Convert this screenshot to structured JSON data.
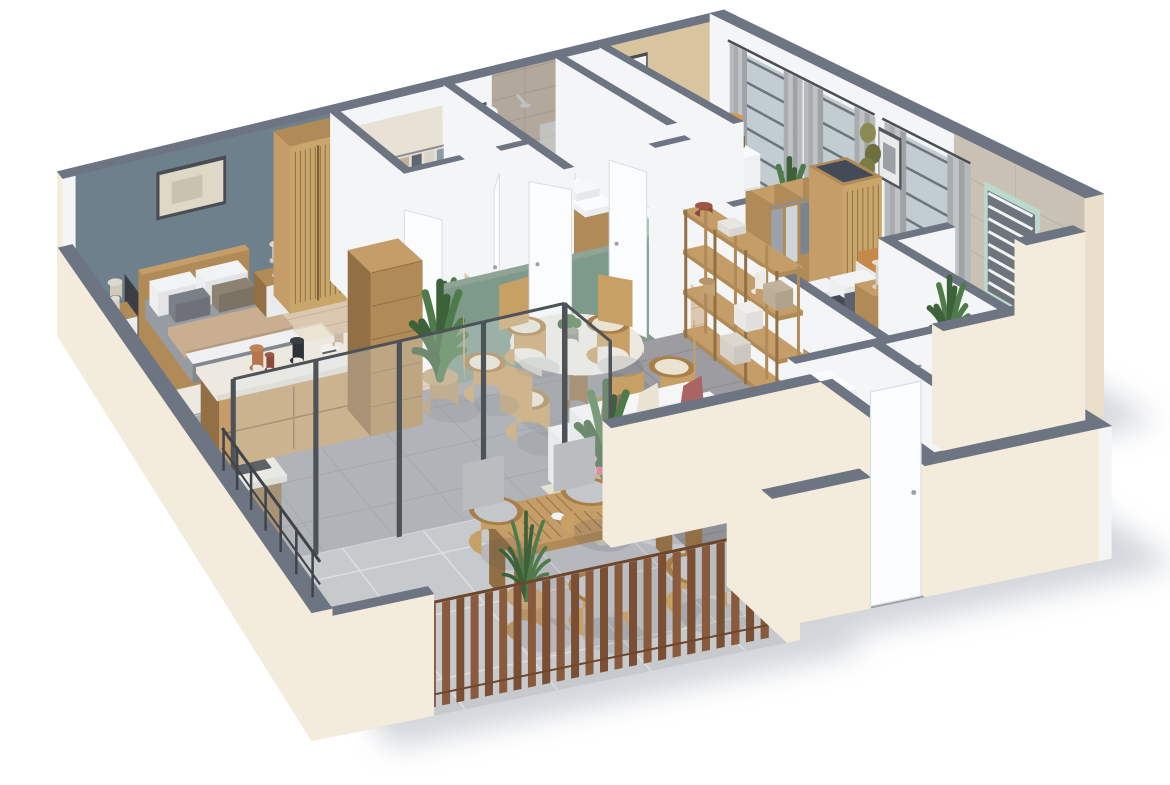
{
  "meta": {
    "title": "3D isometric apartment floor plan render",
    "style": "photoreal cutaway dollhouse view, white background, soft drop shadow"
  },
  "palette": {
    "background": "#ffffff",
    "shadow": "#c6cad0",
    "wallTop": "#6d7583",
    "wallTopDark": "#5d6572",
    "extWall": "#f3ebdb",
    "extWallDark": "#e9dfca",
    "intWall": "#f3f5f7",
    "intWallShade": "#e4e8ed",
    "intWallDark": "#d7dce2",
    "blueWall": "#6d808c",
    "tanWall": "#d8c5a0",
    "sageWall": "#7e9a8b",
    "sageTop": "#8fa396",
    "sageFloor": "#7f998c",
    "woodFloor": "#dbc8b0",
    "woodFloorLine": "#c8b293",
    "grayTile": "#9c9ca1",
    "grayTileLine": "#8e8e93",
    "terraceTile": "#c7cacd",
    "terraceTileLine": "#dbdee1",
    "bathFloor": "#eceef0",
    "wcFloor": "#d9dbde",
    "showerTile": "#b2a89b",
    "showerTileLine": "#a39a8d",
    "ensuiteTile": "#c9c2b4",
    "ensuiteTileLine": "#bab2a2",
    "oak": "#b08a57",
    "oakDark": "#926f45",
    "oakLight": "#c49d69",
    "cane": "#c9a76b",
    "marble": "#ede9e1",
    "marbleSide": "#e0dbd2",
    "steel": "#bcc2c6",
    "dark": "#2e3136",
    "white": "#fafbfc",
    "crib": "#e7eaec",
    "sofa": "#ececec",
    "sofaShade": "#dadada",
    "sofaLight": "#f6f6f6",
    "rose": "#b06c6c",
    "creamCushion": "#eae3d1",
    "bedGray": "#979ba2",
    "bedGrayDark": "#83878e",
    "throw": "#c9ae90",
    "rugCream": "#ebe4d3",
    "rugOlive": "#9c9c72",
    "rugBeige": "#e9e1cb",
    "runner": "#6f5b4a",
    "green": "#4f7b4a",
    "greenDark": "#3d6139",
    "rattan": "#c7a066",
    "rattanDark": "#a87f48",
    "curtain": "#b7babc",
    "curtainDark": "#a8acae",
    "mint": "#bcd9cf",
    "towel": "#9cc3ae",
    "glass": "#dfe9ec",
    "frame": "#70767c",
    "door": "#fbfcfd",
    "doorEdge": "#d9dee3",
    "orange": "#c58a4a",
    "olive": "#7f7f4f",
    "oliveDark": "#6c6c3e",
    "terra": "#b5764f",
    "lampOrange": "#cf8f3f",
    "navy": "#434a58",
    "blanket": "#9aa0a5",
    "basket": "#c3a376",
    "basketDark": "#b5946a",
    "windowGlass": "#c2cdd2",
    "louverDark": "#6d747c",
    "railing": "#3f444a",
    "fence": "#8a5a3c",
    "fenceDark": "#7b4f34"
  },
  "rooms": [
    {
      "id": "master-bedroom",
      "label": "Master bedroom",
      "floor": "wood",
      "accent_wall": "#6d808c",
      "furniture": [
        "double bed with gray duvet and beige throw",
        "white and gray pillows",
        "wood headboard",
        "2 wood nightstands",
        "2 table lamps",
        "framed wall art",
        "cream area rug",
        "cane-front wardrobe",
        "TV panel"
      ]
    },
    {
      "id": "master-closet",
      "label": "Walk-in closet",
      "floor": "wood",
      "furniture": [
        "hanging clothes racks",
        "white dresser"
      ]
    },
    {
      "id": "bathroom",
      "label": "Family bathroom",
      "floor": "white",
      "furniture": [
        "walk-in tiled shower with glass screen",
        "water heater cylinder",
        "toilet",
        "double-sink wood vanity",
        "towel radiator with green towel",
        "framed botanical art"
      ]
    },
    {
      "id": "nursery",
      "label": "Nursery",
      "floor": "wood",
      "accent_wall": "#d8c5a0",
      "furniture": [
        "white crib with wood panels",
        "changing dresser with olive pad",
        "orange floor lamp",
        "round olive rug",
        "potted plant",
        "framed triangle art",
        "gray curtains with window"
      ]
    },
    {
      "id": "bedroom-2",
      "label": "Bedroom 2",
      "floor": "wood",
      "furniture": [
        "double bed with striped bedding",
        "dark pillows",
        "open wardrobes with clothes",
        "cane wardrobe",
        "bench with orange cushion",
        "nightstand with lamp",
        "gray curtains with windows",
        "olive wall discs",
        "framed art",
        "dark runner rug"
      ]
    },
    {
      "id": "ensuite-bathroom",
      "label": "En-suite bathroom",
      "floor": "tile",
      "furniture": [
        "beige tiled walls",
        "louver window with mint frame",
        "white vanity basin",
        "potted plant"
      ]
    },
    {
      "id": "kitchen",
      "label": "Kitchen",
      "floor": "gray tile",
      "furniture": [
        "L-shaped marble counter",
        "wood drawer island",
        "steel sink with faucet",
        "black cooktop with pot",
        "tall wood cabinet",
        "counter decor (sculpture, kettle, plates)",
        "banana plant in woven basket"
      ]
    },
    {
      "id": "dining-area",
      "label": "Dining area",
      "floor": "gray tile",
      "half_wall": "#7e9a8b",
      "furniture": [
        "round marble pedestal table",
        "6 rattan chairs with cushions",
        "green centerpiece"
      ]
    },
    {
      "id": "living-room",
      "label": "Living room",
      "floor": "gray tile",
      "furniture": [
        "white 2-seat sofa",
        "rose and cream cushions",
        "round white coffee table",
        "wood side table",
        "rattan armchair",
        "TV on wood media console",
        "wood shelving etagere with decor",
        "beige rug",
        "pampas vase",
        "tall plant"
      ]
    },
    {
      "id": "terrace",
      "label": "Terrace",
      "floor": "light gray tile",
      "furniture": [
        "slatted wood dining table",
        "4 rattan chairs with gray cushions",
        "flower vase",
        "deco spheres",
        "palm plant",
        "wood slat fence",
        "dark metal railing"
      ]
    },
    {
      "id": "entry",
      "label": "Entry hall",
      "floor": "gray tile",
      "furniture": [
        "white front door",
        "wood door mat"
      ]
    },
    {
      "id": "wc",
      "label": "WC + washroom",
      "floor": "tile",
      "furniture": [
        "toilet",
        "hand basin",
        "green towel bar",
        "white cabinet"
      ]
    }
  ]
}
